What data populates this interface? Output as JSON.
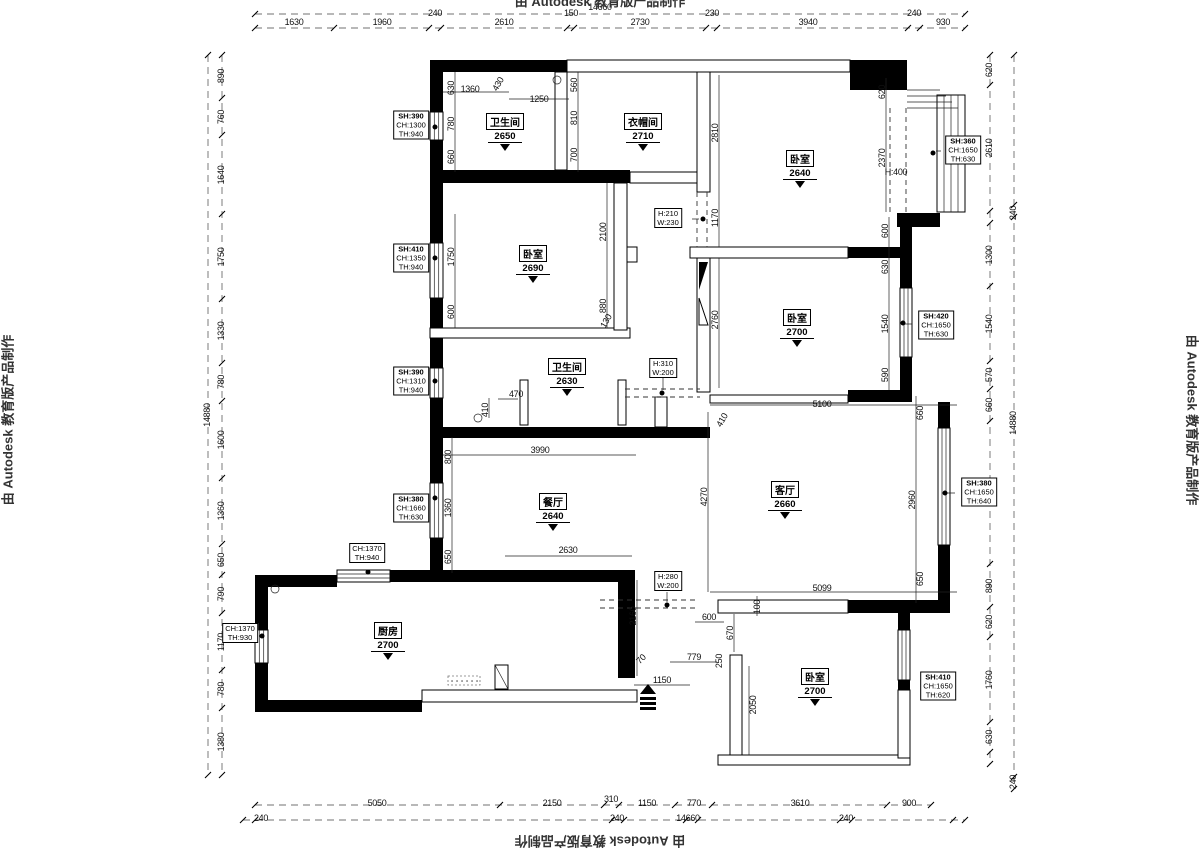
{
  "watermark": "由 Autodesk 教育版产品制作",
  "rooms": [
    {
      "name": "卫生间",
      "elev": "2650",
      "x": 505,
      "y": 113
    },
    {
      "name": "衣帽间",
      "elev": "2710",
      "x": 643,
      "y": 113
    },
    {
      "name": "卧室",
      "elev": "2640",
      "x": 800,
      "y": 150
    },
    {
      "name": "卧室",
      "elev": "2690",
      "x": 533,
      "y": 245
    },
    {
      "name": "卧室",
      "elev": "2700",
      "x": 797,
      "y": 309
    },
    {
      "name": "卫生间",
      "elev": "2630",
      "x": 567,
      "y": 358
    },
    {
      "name": "餐厅",
      "elev": "2640",
      "x": 553,
      "y": 493
    },
    {
      "name": "客厅",
      "elev": "2660",
      "x": 785,
      "y": 481
    },
    {
      "name": "厨房",
      "elev": "2700",
      "x": 388,
      "y": 622
    },
    {
      "name": "卧室",
      "elev": "2700",
      "x": 815,
      "y": 668
    }
  ],
  "tags": [
    {
      "lines": [
        "SH:390",
        "CH:1300",
        "TH:940"
      ],
      "x": 411,
      "y": 125
    },
    {
      "lines": [
        "SH:360",
        "CH:1650",
        "TH:630"
      ],
      "x": 963,
      "y": 150
    },
    {
      "lines": [
        "SH:410",
        "CH:1350",
        "TH:940"
      ],
      "x": 411,
      "y": 258
    },
    {
      "lines": [
        "SH:420",
        "CH:1650",
        "TH:630"
      ],
      "x": 936,
      "y": 325
    },
    {
      "lines": [
        "SH:390",
        "CH:1310",
        "TH:940"
      ],
      "x": 411,
      "y": 381
    },
    {
      "lines": [
        "SH:380",
        "CH:1660",
        "TH:630"
      ],
      "x": 411,
      "y": 508
    },
    {
      "lines": [
        "SH:380",
        "CH:1650",
        "TH:640"
      ],
      "x": 979,
      "y": 492
    },
    {
      "lines": [
        "CH:1370",
        "TH:940"
      ],
      "x": 367,
      "y": 553
    },
    {
      "lines": [
        "CH:1370",
        "TH:930"
      ],
      "x": 240,
      "y": 633
    },
    {
      "lines": [
        "SH:410",
        "CH:1650",
        "TH:620"
      ],
      "x": 938,
      "y": 686
    },
    {
      "lines": [
        "H:210",
        "W:230"
      ],
      "x": 668,
      "y": 218
    },
    {
      "lines": [
        "H:310",
        "W:200"
      ],
      "x": 663,
      "y": 368
    },
    {
      "lines": [
        "H:280",
        "W:200"
      ],
      "x": 668,
      "y": 581
    }
  ],
  "dims": [
    {
      "t": "14660",
      "x": 600,
      "y": 7
    },
    {
      "t": "1630",
      "x": 294,
      "y": 22
    },
    {
      "t": "1960",
      "x": 382,
      "y": 22
    },
    {
      "t": "240",
      "x": 435,
      "y": 13
    },
    {
      "t": "2610",
      "x": 504,
      "y": 22
    },
    {
      "t": "150",
      "x": 571,
      "y": 13
    },
    {
      "t": "2730",
      "x": 640,
      "y": 22
    },
    {
      "t": "230",
      "x": 712,
      "y": 13
    },
    {
      "t": "3940",
      "x": 808,
      "y": 22
    },
    {
      "t": "240",
      "x": 914,
      "y": 13
    },
    {
      "t": "930",
      "x": 943,
      "y": 22
    },
    {
      "t": "14880",
      "x": 207,
      "y": 415,
      "r": -90
    },
    {
      "t": "890",
      "x": 221,
      "y": 76,
      "r": -90
    },
    {
      "t": "760",
      "x": 221,
      "y": 117,
      "r": -90
    },
    {
      "t": "1640",
      "x": 221,
      "y": 175,
      "r": -90
    },
    {
      "t": "1750",
      "x": 221,
      "y": 257,
      "r": -90
    },
    {
      "t": "1330",
      "x": 221,
      "y": 331,
      "r": -90
    },
    {
      "t": "780",
      "x": 221,
      "y": 382,
      "r": -90
    },
    {
      "t": "1600",
      "x": 221,
      "y": 440,
      "r": -90
    },
    {
      "t": "1360",
      "x": 221,
      "y": 511,
      "r": -90
    },
    {
      "t": "650",
      "x": 221,
      "y": 560,
      "r": -90
    },
    {
      "t": "790",
      "x": 221,
      "y": 594,
      "r": -90
    },
    {
      "t": "1170",
      "x": 221,
      "y": 642,
      "r": -90
    },
    {
      "t": "780",
      "x": 221,
      "y": 689,
      "r": -90
    },
    {
      "t": "1380",
      "x": 221,
      "y": 742,
      "r": -90
    },
    {
      "t": "620",
      "x": 989,
      "y": 70,
      "r": -90
    },
    {
      "t": "2610",
      "x": 989,
      "y": 148,
      "r": -90
    },
    {
      "t": "1300",
      "x": 989,
      "y": 255,
      "r": -90
    },
    {
      "t": "1540",
      "x": 989,
      "y": 324,
      "r": -90
    },
    {
      "t": "570",
      "x": 989,
      "y": 375,
      "r": -90
    },
    {
      "t": "660",
      "x": 989,
      "y": 405,
      "r": -90
    },
    {
      "t": "2960",
      "x": 989,
      "y": 493,
      "r": -90
    },
    {
      "t": "890",
      "x": 989,
      "y": 586,
      "r": -90
    },
    {
      "t": "620",
      "x": 989,
      "y": 622,
      "r": -90
    },
    {
      "t": "1760",
      "x": 989,
      "y": 680,
      "r": -90
    },
    {
      "t": "630",
      "x": 989,
      "y": 737,
      "r": -90
    },
    {
      "t": "240",
      "x": 1013,
      "y": 213,
      "r": -90
    },
    {
      "t": "14880",
      "x": 1013,
      "y": 423,
      "r": -90
    },
    {
      "t": "240",
      "x": 1013,
      "y": 782,
      "r": -90
    },
    {
      "t": "5050",
      "x": 377,
      "y": 803
    },
    {
      "t": "2150",
      "x": 552,
      "y": 803
    },
    {
      "t": "310",
      "x": 611,
      "y": 799
    },
    {
      "t": "1150",
      "x": 647,
      "y": 803
    },
    {
      "t": "770",
      "x": 694,
      "y": 803
    },
    {
      "t": "3610",
      "x": 800,
      "y": 803
    },
    {
      "t": "900",
      "x": 909,
      "y": 803
    },
    {
      "t": "240",
      "x": 261,
      "y": 818
    },
    {
      "t": "240",
      "x": 617,
      "y": 818
    },
    {
      "t": "14660",
      "x": 688,
      "y": 818
    },
    {
      "t": "240",
      "x": 846,
      "y": 818
    },
    {
      "t": "1360",
      "x": 470,
      "y": 89
    },
    {
      "t": "430",
      "x": 498,
      "y": 84,
      "r": -60
    },
    {
      "t": "1250",
      "x": 539,
      "y": 99
    },
    {
      "t": "630",
      "x": 451,
      "y": 88,
      "r": -90
    },
    {
      "t": "780",
      "x": 451,
      "y": 124,
      "r": -90
    },
    {
      "t": "660",
      "x": 451,
      "y": 157,
      "r": -90
    },
    {
      "t": "560",
      "x": 574,
      "y": 85,
      "r": -90
    },
    {
      "t": "810",
      "x": 574,
      "y": 118,
      "r": -90
    },
    {
      "t": "700",
      "x": 574,
      "y": 155,
      "r": -90
    },
    {
      "t": "2810",
      "x": 715,
      "y": 133,
      "r": -90
    },
    {
      "t": "620",
      "x": 882,
      "y": 92,
      "r": -90
    },
    {
      "t": "2370",
      "x": 882,
      "y": 158,
      "r": -90
    },
    {
      "t": "H:400",
      "x": 896,
      "y": 172
    },
    {
      "t": "1170",
      "x": 715,
      "y": 218,
      "r": -90
    },
    {
      "t": "600",
      "x": 885,
      "y": 231,
      "r": -90
    },
    {
      "t": "630",
      "x": 885,
      "y": 267,
      "r": -90
    },
    {
      "t": "1540",
      "x": 885,
      "y": 324,
      "r": -90
    },
    {
      "t": "590",
      "x": 885,
      "y": 375,
      "r": -90
    },
    {
      "t": "2760",
      "x": 715,
      "y": 320,
      "r": -90
    },
    {
      "t": "2100",
      "x": 603,
      "y": 232,
      "r": -90
    },
    {
      "t": "880",
      "x": 603,
      "y": 306,
      "r": -90
    },
    {
      "t": "130",
      "x": 606,
      "y": 321,
      "r": -60
    },
    {
      "t": "1750",
      "x": 451,
      "y": 257,
      "r": -90
    },
    {
      "t": "600",
      "x": 451,
      "y": 312,
      "r": -90
    },
    {
      "t": "470",
      "x": 516,
      "y": 394
    },
    {
      "t": "410",
      "x": 485,
      "y": 410,
      "r": -90
    },
    {
      "t": "3990",
      "x": 540,
      "y": 450
    },
    {
      "t": "800",
      "x": 448,
      "y": 457,
      "r": -90
    },
    {
      "t": "1360",
      "x": 448,
      "y": 508,
      "r": -90
    },
    {
      "t": "650",
      "x": 448,
      "y": 557,
      "r": -90
    },
    {
      "t": "2630",
      "x": 568,
      "y": 550
    },
    {
      "t": "5100",
      "x": 822,
      "y": 404
    },
    {
      "t": "410",
      "x": 722,
      "y": 420,
      "r": -60
    },
    {
      "t": "4270",
      "x": 704,
      "y": 497,
      "r": -90
    },
    {
      "t": "2960",
      "x": 912,
      "y": 500,
      "r": -90
    },
    {
      "t": "660",
      "x": 920,
      "y": 413,
      "r": -90
    },
    {
      "t": "650",
      "x": 920,
      "y": 579,
      "r": -90
    },
    {
      "t": "5099",
      "x": 822,
      "y": 588
    },
    {
      "t": "100",
      "x": 757,
      "y": 607,
      "r": -90
    },
    {
      "t": "600",
      "x": 709,
      "y": 617
    },
    {
      "t": "670",
      "x": 730,
      "y": 633,
      "r": -90
    },
    {
      "t": "2160",
      "x": 633,
      "y": 616,
      "r": -90
    },
    {
      "t": "70",
      "x": 641,
      "y": 659,
      "r": -45
    },
    {
      "t": "779",
      "x": 694,
      "y": 657
    },
    {
      "t": "250",
      "x": 719,
      "y": 661,
      "r": -90
    },
    {
      "t": "1150",
      "x": 662,
      "y": 680
    },
    {
      "t": "2050",
      "x": 753,
      "y": 705,
      "r": -90
    }
  ]
}
